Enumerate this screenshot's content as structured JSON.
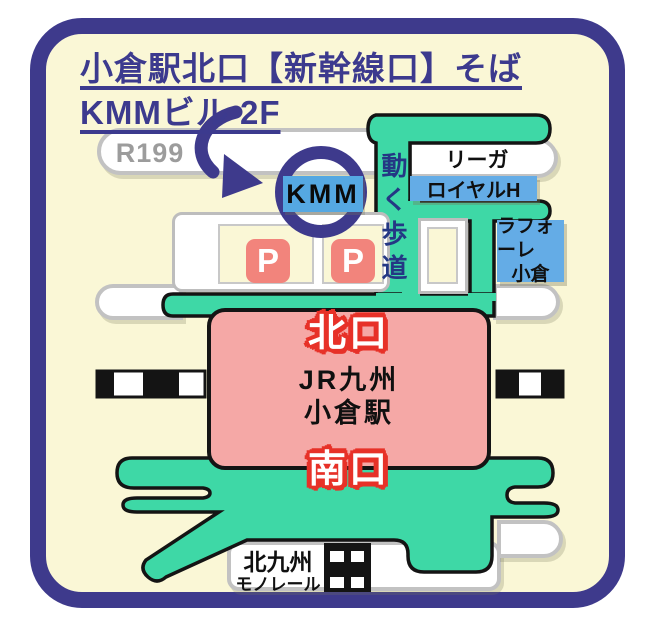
{
  "title": {
    "line1": "小倉駅北口【新幹線口】そば",
    "line2": "KMMビル 2F"
  },
  "map": {
    "route_label": "R199",
    "kmm_label": "KMM",
    "walkway_label": "動く歩道",
    "hotel_line1": "リーガ",
    "hotel_line2": "ロイヤルH",
    "laforet_line1": "ラフォーレ",
    "laforet_line2": "小倉",
    "north_exit": "北口",
    "station_line1": "JR九州",
    "station_line2": "小倉駅",
    "south_exit": "南口",
    "monorail_line1": "北九州",
    "monorail_line2": "モノレール",
    "parking_label": "P"
  },
  "colors": {
    "frame_navy": "#3E3A8C",
    "map_cream": "#FAF7D6",
    "road_green": "#3ED8A6",
    "road_outline": "#141414",
    "white_road_border": "#C2C2C2",
    "station_pink": "#F5A8A6",
    "exit_red": "#E73128",
    "kmm_blue": "#55A8E2",
    "hotel_blue": "#64ACE6",
    "parking_salmon": "#F2847C",
    "walkway_text_blue": "#243784"
  }
}
